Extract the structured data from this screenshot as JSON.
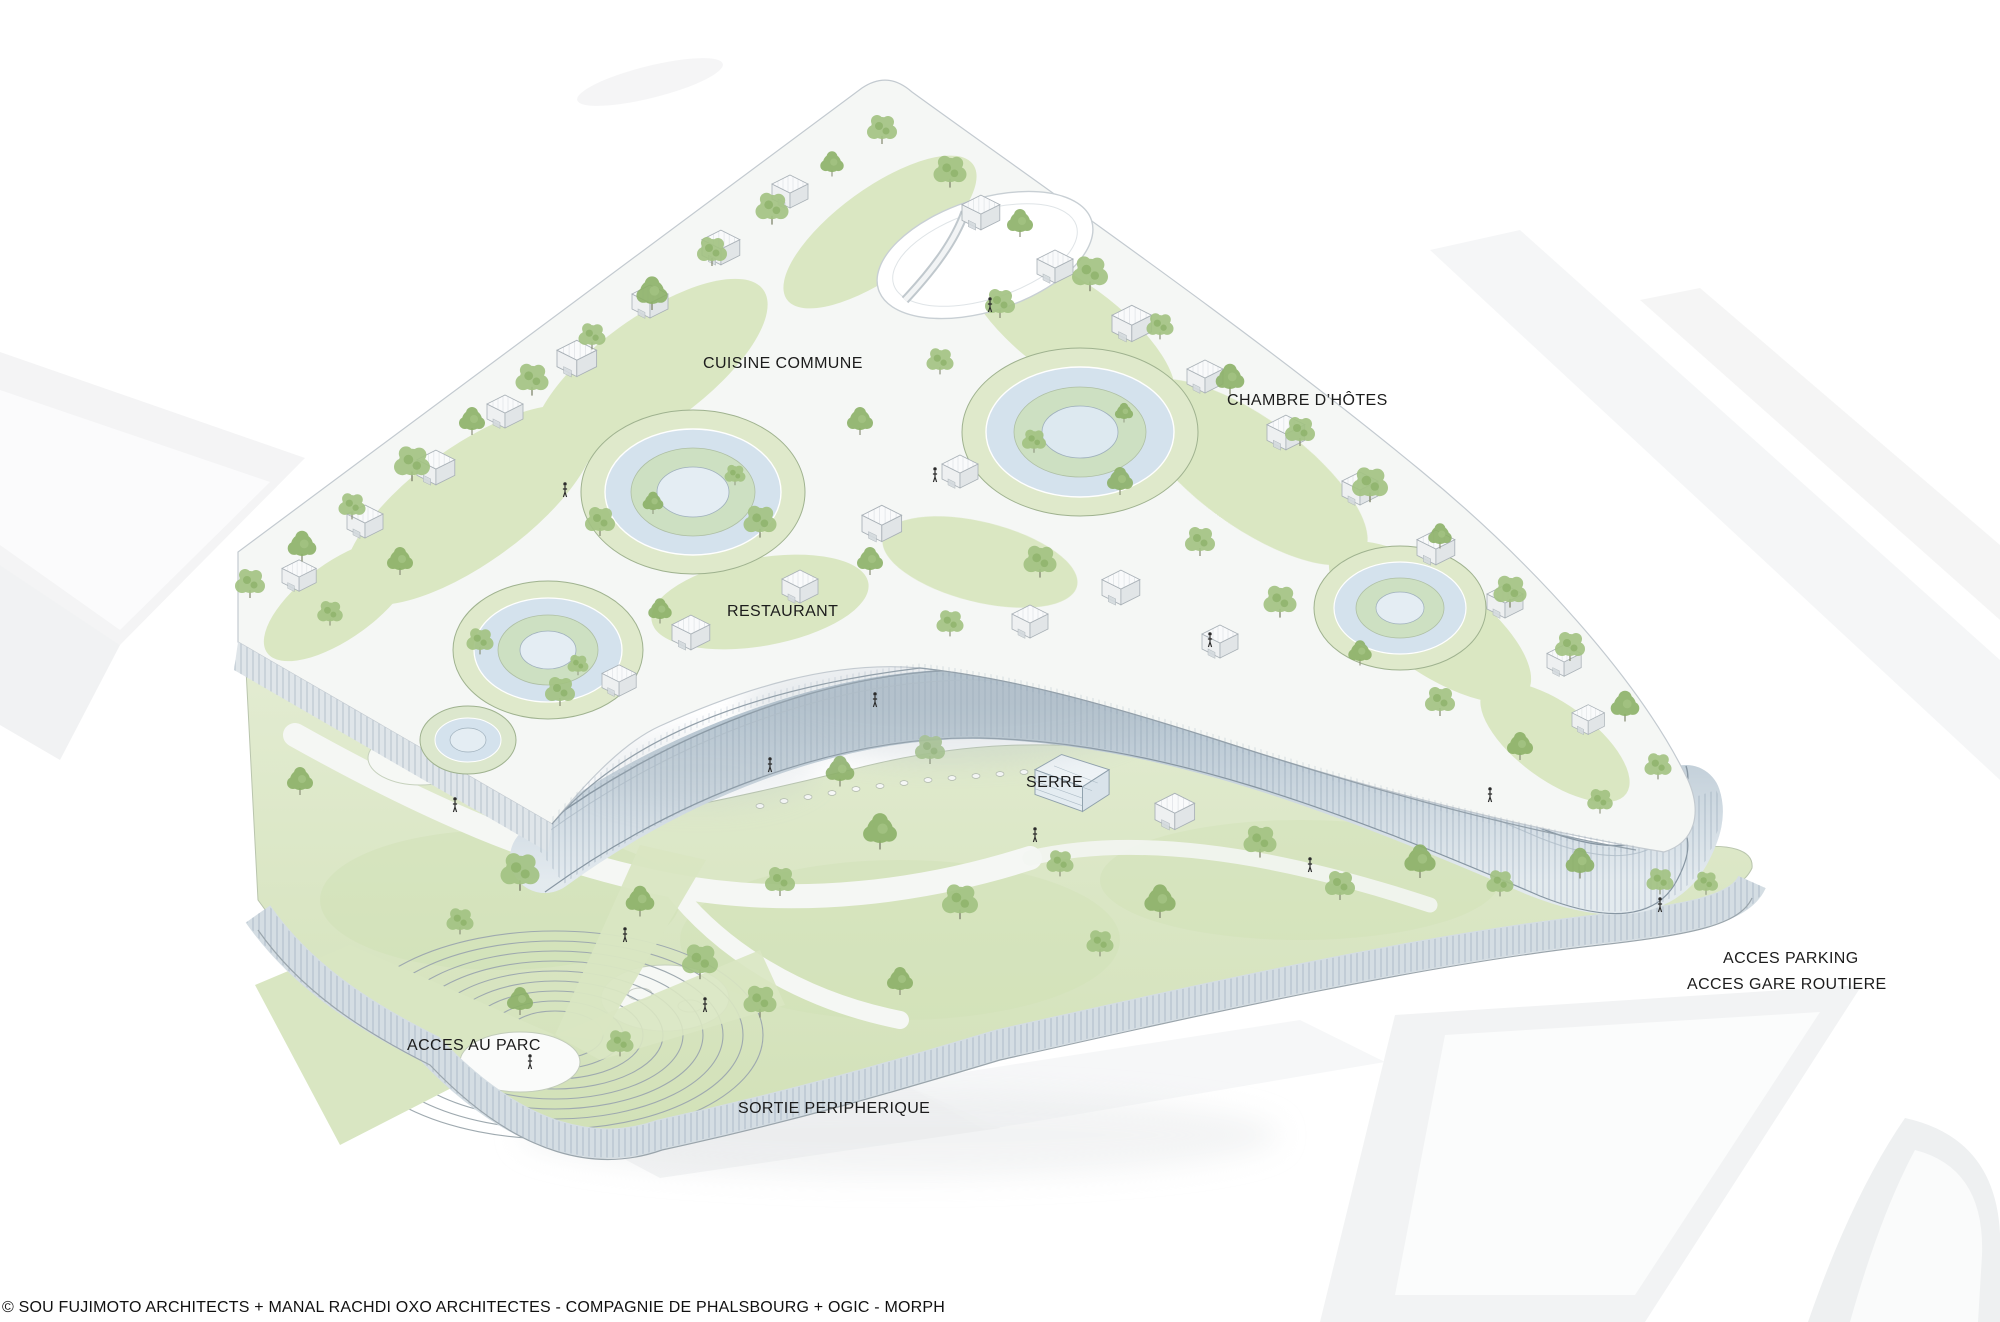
{
  "annotations": {
    "cuisine_commune": "CUISINE COMMUNE",
    "chambre_dhotes": "CHAMBRE D’HÔTES",
    "restaurant": "RESTAURANT",
    "serre": "SERRE",
    "acces_parking": "ACCES PARKING",
    "acces_gare_routiere": "ACCES GARE ROUTIERE",
    "acces_au_parc": "ACCES AU PARC",
    "sortie_peripherique": "SORTIE PERIPHERIQUE"
  },
  "credit": "© SOU FUJIMOTO ARCHITECTS + MANAL RACHDI OXO ARCHITECTES - COMPAGNIE DE PHALSBOURG + OGIC - MORPH",
  "colors": {
    "foliage": "#a3c383",
    "foliage_dark": "#8cb168",
    "grass": "#d9e6c2",
    "glass": "#ccdbe4",
    "label": "#1c1c1c"
  }
}
